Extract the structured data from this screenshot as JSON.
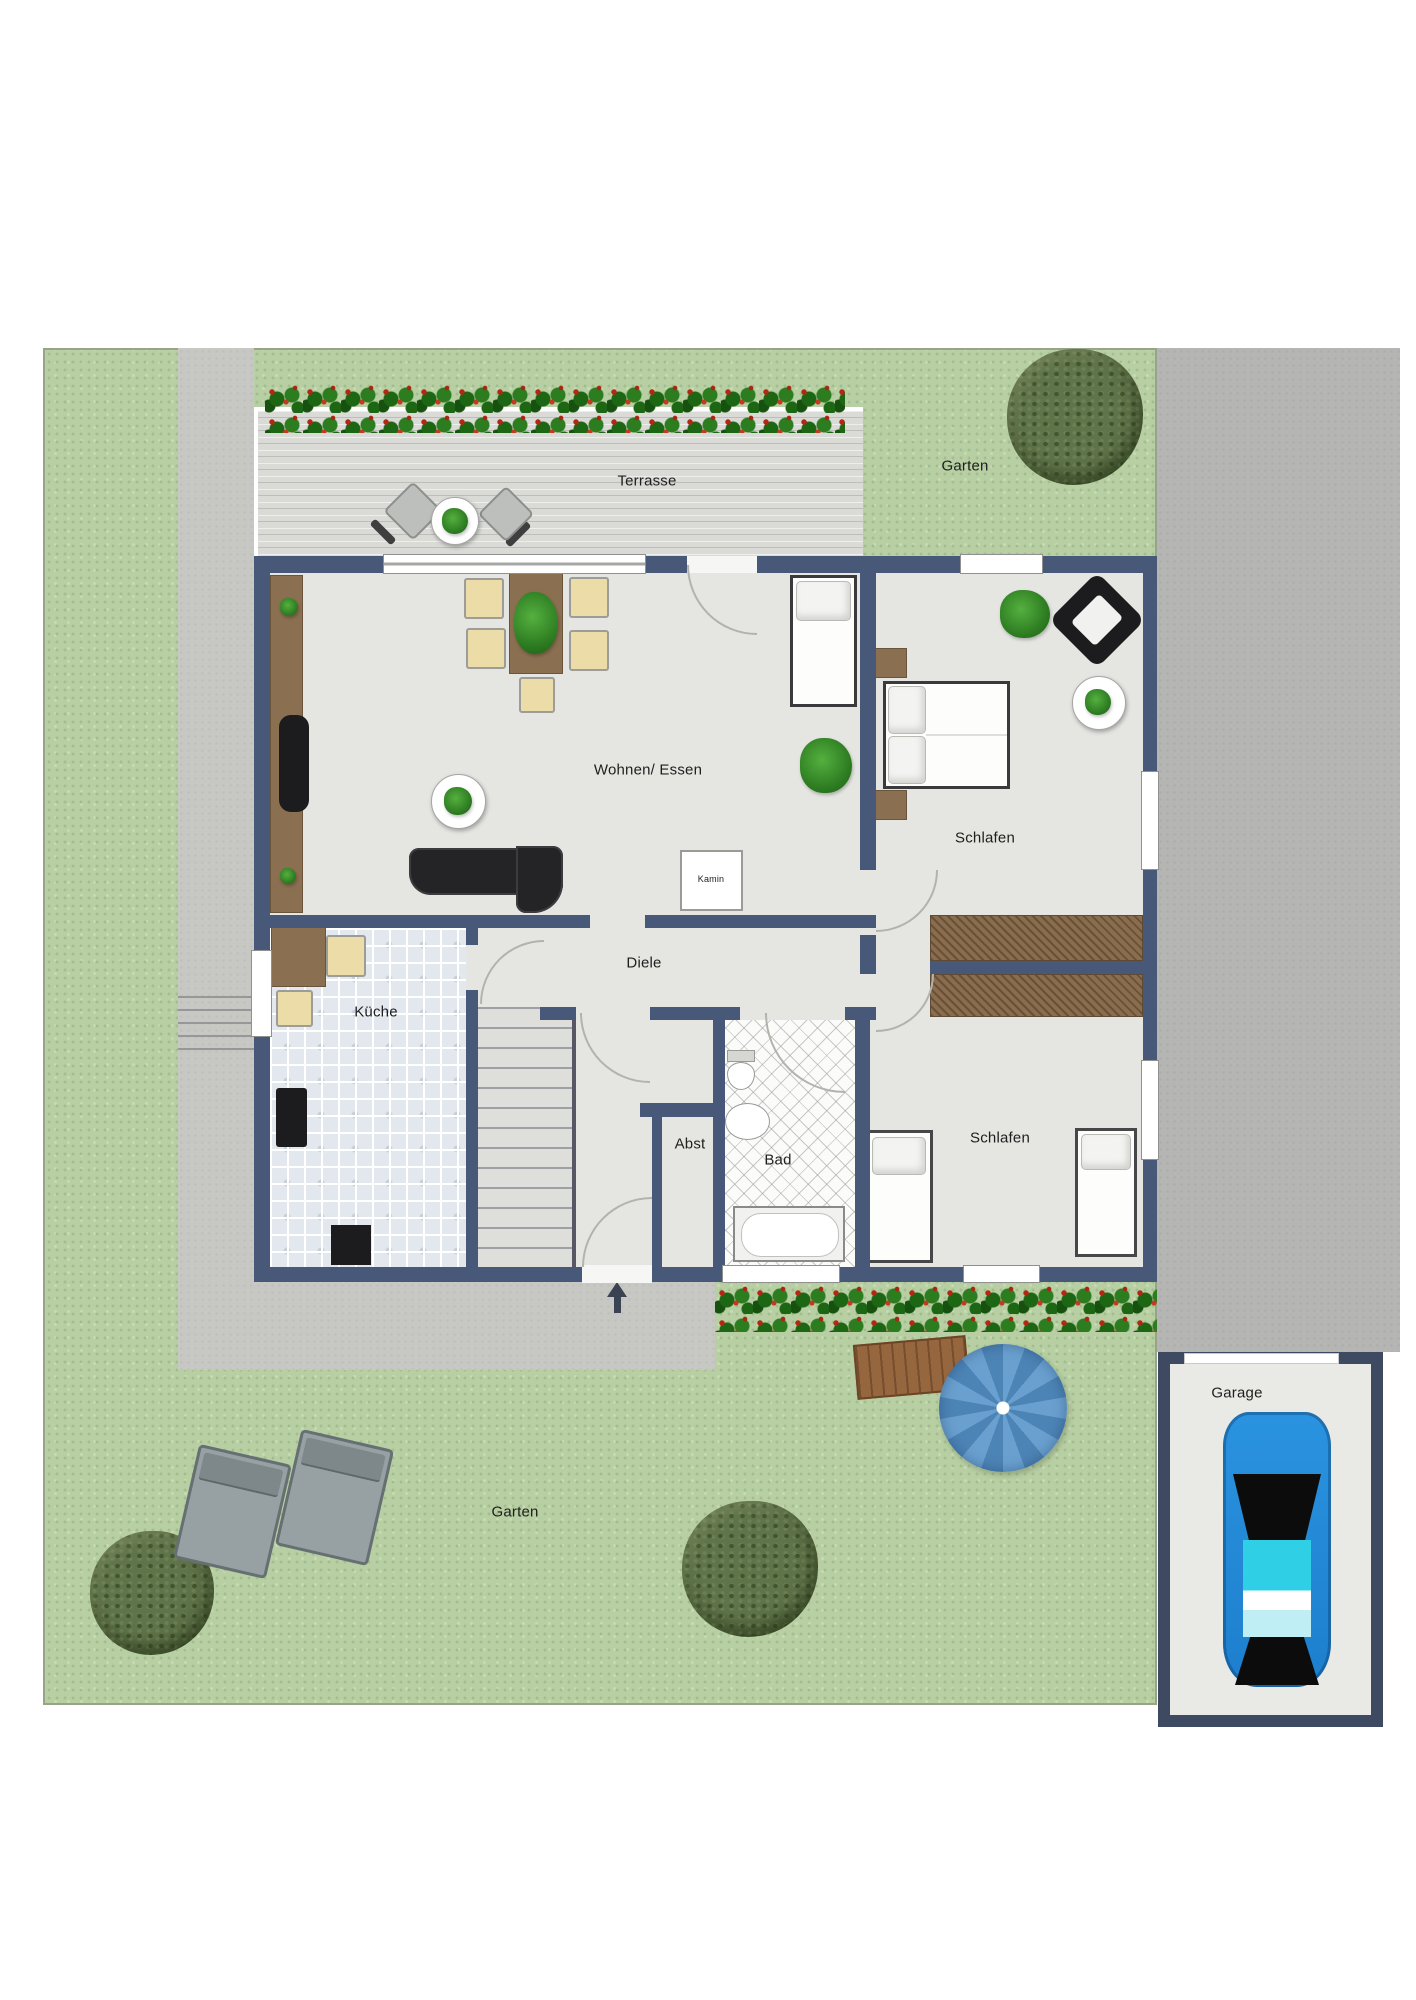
{
  "floorplan": {
    "labels": {
      "terrace": "Terrasse",
      "garden_top": "Garten",
      "living": "Wohnen/ Essen",
      "bedroom_top": "Schlafen",
      "fireplace": "Kamin",
      "hall": "Diele",
      "kitchen": "Küche",
      "storage": "Abst",
      "bath": "Bad",
      "bedroom_bottom": "Schlafen",
      "garden_bottom": "Garten",
      "garage": "Garage"
    },
    "colors": {
      "lawn": "#b7cfa3",
      "paving": "#c7c7c4",
      "driveway": "#b5b5b3",
      "terrace_deck": "#dadad7",
      "wall": "#485878",
      "floor": "#e5e5e2",
      "wood_furniture": "#8b6f51",
      "hedge_green": "#267117",
      "hedge_red": "#c23320",
      "tree": "#5b6f45",
      "parasol": "#5d94c8",
      "car": "#1d86d8"
    },
    "icons": {
      "entrance_arrow": "up-arrow"
    }
  }
}
